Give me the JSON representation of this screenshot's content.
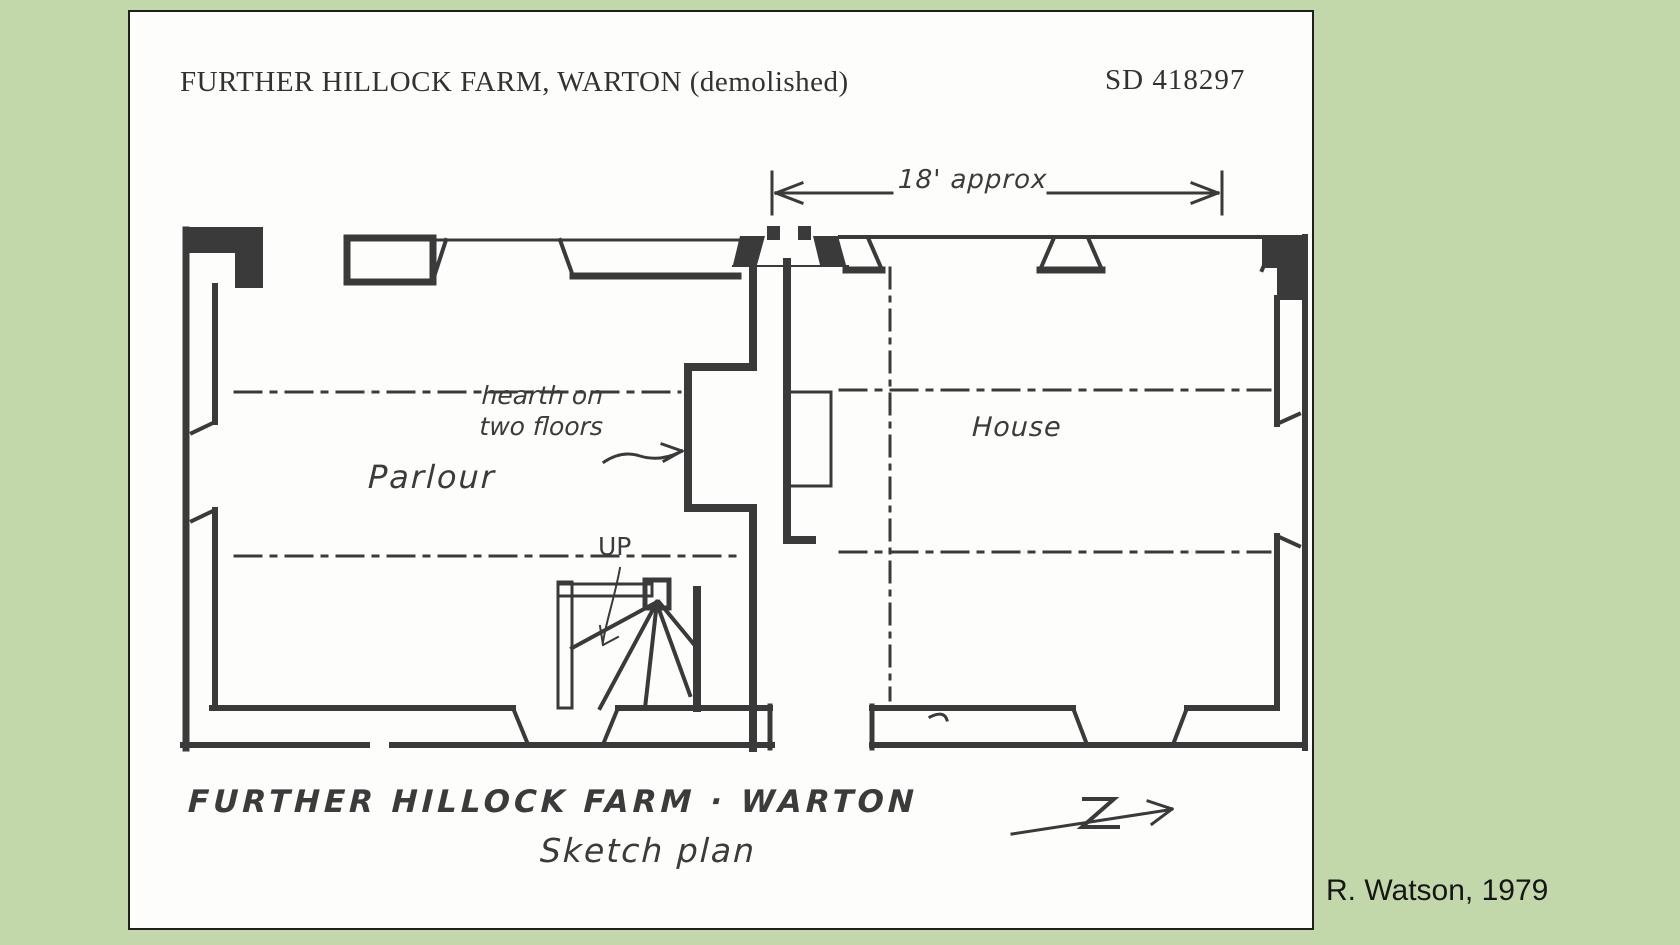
{
  "scan": {
    "background_color": "#c3d8aa",
    "paper_color": "#fdfdfc",
    "ink_color": "#3a3a3a",
    "credit": "R. Watson, 1979"
  },
  "header": {
    "title": "FURTHER HILLOCK FARM, WARTON (demolished)",
    "grid_reference": "SD 418297"
  },
  "plan": {
    "dimension_label": "18' approx",
    "room_labels": {
      "parlour": "Parlour",
      "house": "House"
    },
    "hearth_note": {
      "line1": "hearth on",
      "line2": "two floors"
    },
    "stair_label": "UP",
    "caption": {
      "line1": "FURTHER HILLOCK FARM · WARTON",
      "line2": "Sketch plan"
    }
  }
}
